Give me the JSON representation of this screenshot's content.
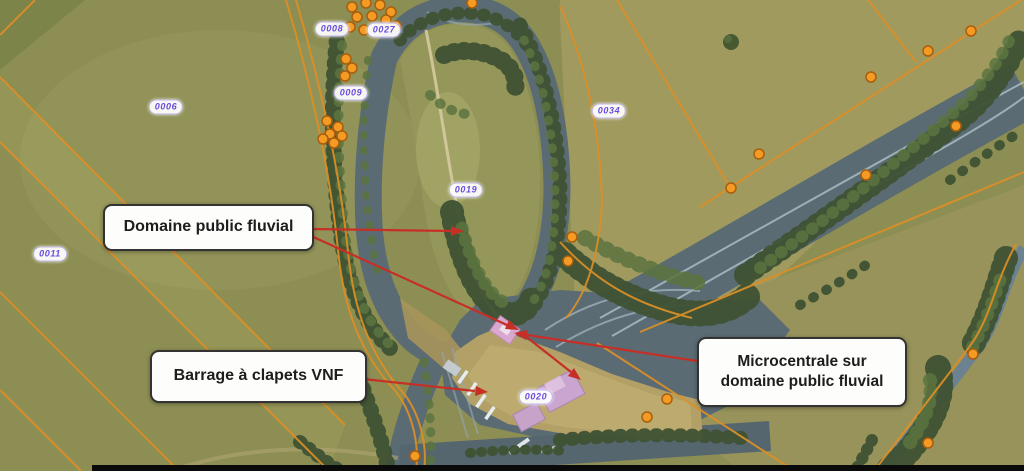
{
  "map_type": "aerial-cadastral-annotated",
  "callouts": [
    {
      "id": "domaine",
      "label": "Domaine public fluvial"
    },
    {
      "id": "barrage",
      "label": "Barrage à clapets VNF"
    },
    {
      "id": "microcentrale",
      "label": "Microcentrale sur domaine public fluvial",
      "lines": [
        "Microcentrale sur",
        "domaine public fluvial"
      ]
    }
  ],
  "parcels": [
    {
      "label": "0008"
    },
    {
      "label": "0027"
    },
    {
      "label": "0009"
    },
    {
      "label": "0006"
    },
    {
      "label": "0034"
    },
    {
      "label": "0019"
    },
    {
      "label": "0011"
    },
    {
      "label": "0020"
    }
  ],
  "colors": {
    "field_olive": "#8d8e53",
    "field_tan": "#a09a5f",
    "water": "#5b6b74",
    "sand": "#b2a066",
    "tree_dark": "#3f5233",
    "cadastral_orange": "#dd8f26",
    "survey_dot_orange": "#f59a22",
    "parcel_purple": "#6b4ce0",
    "arrow_red": "#c62f26",
    "building_pink": "#c9a5cf"
  }
}
